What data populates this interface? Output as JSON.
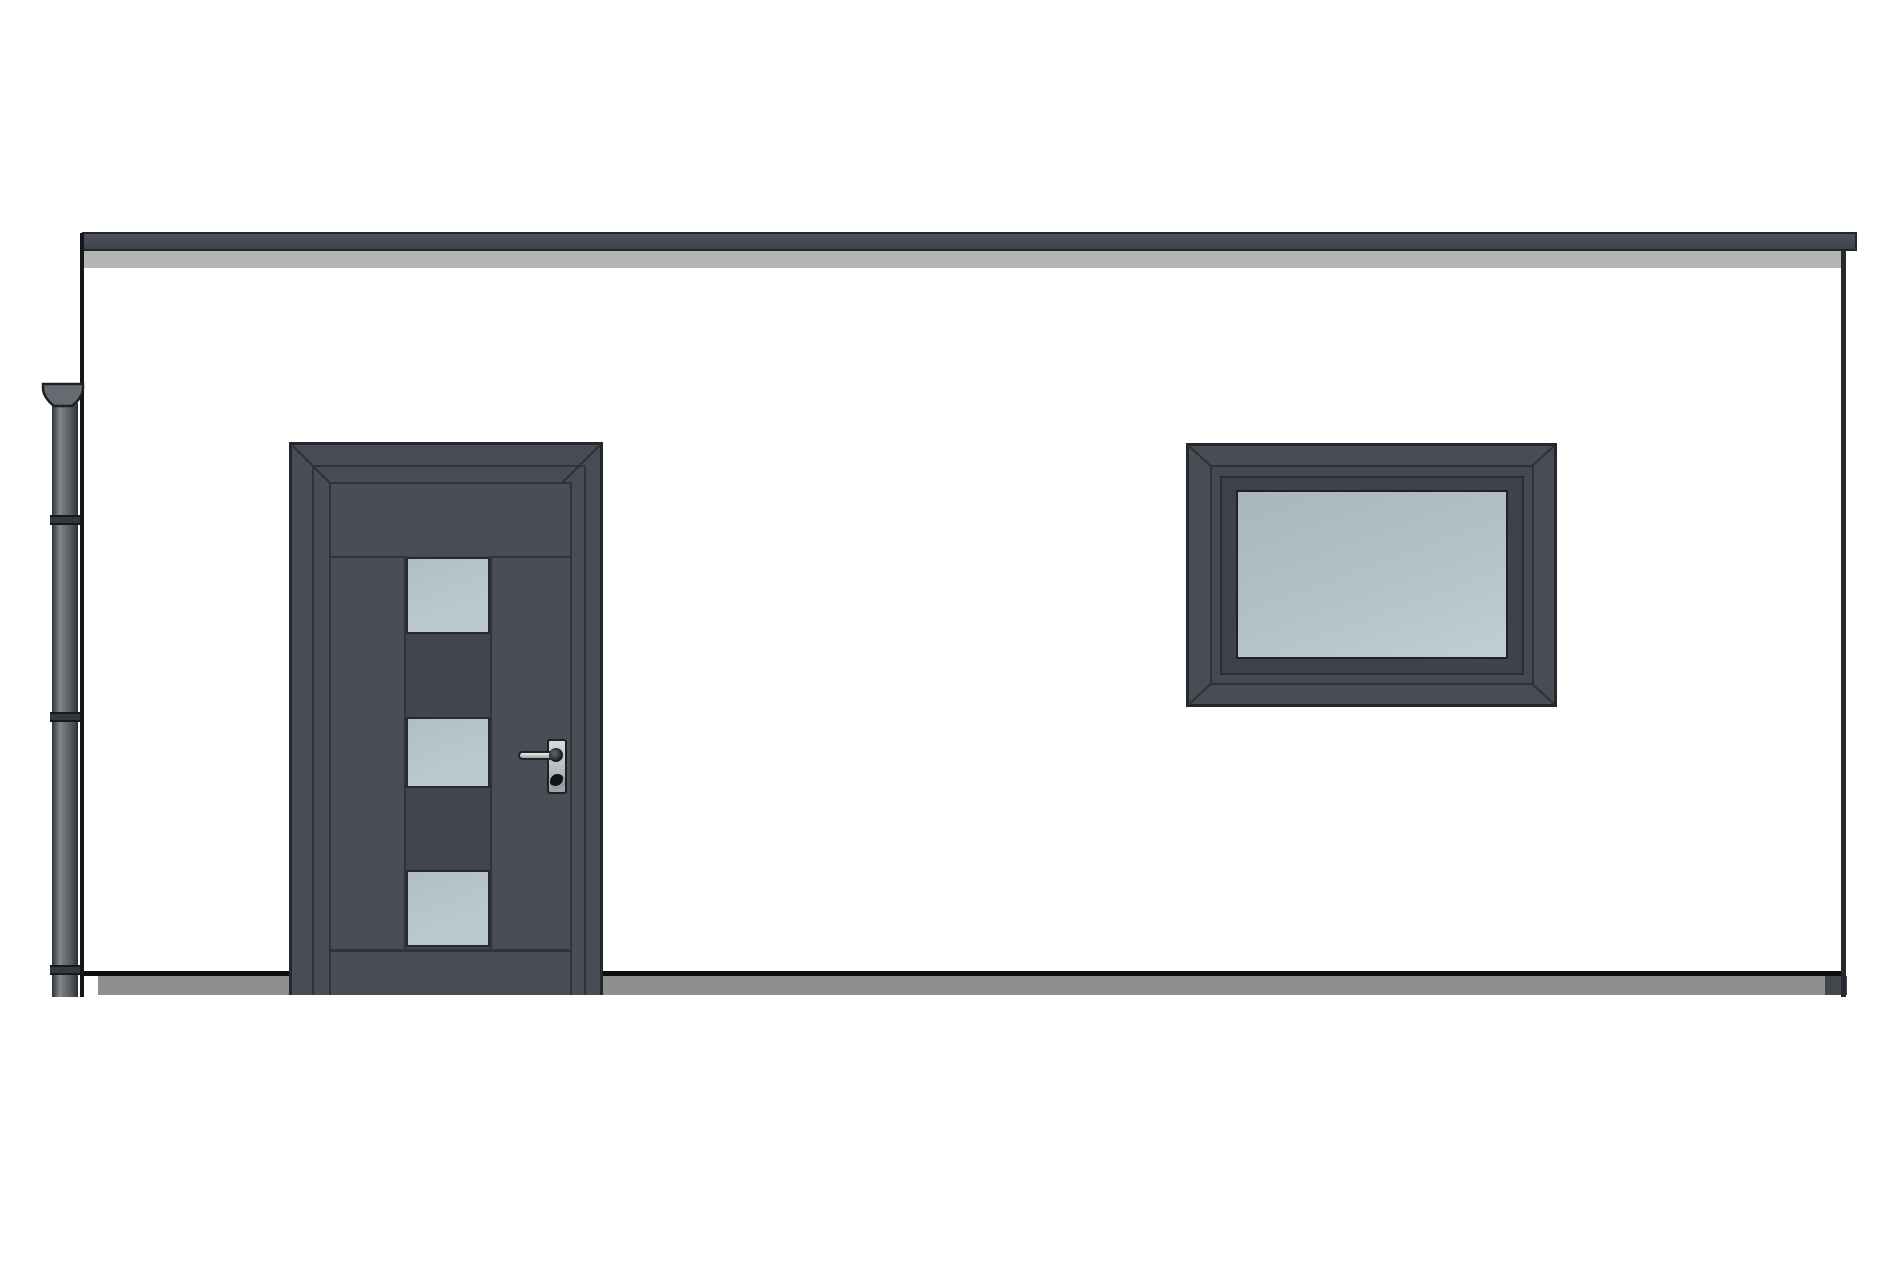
{
  "scene": {
    "type": "architectural elevation drawing",
    "title": "Front elevation - flat-roof building with entrance door, fixed window, downpipe and ground line",
    "components": {
      "roof_fascia": "flat roof fascia band with shadow strip",
      "wall": "white rendered wall",
      "downpipe": "rainwater downpipe with top hopper and pipe collars",
      "door": "anthracite entrance door, three obscured glass panels, lever handle with cylinder keyhole",
      "window": "anthracite fixed window with double-stepped frame and obscured glazing",
      "ground": "ground slab line and paving strip"
    },
    "counts": {
      "door_glass_panels": 3,
      "downpipe_collars": 3
    }
  },
  "colors": {
    "paper": "#ffffff",
    "outline": "#141619",
    "frame_dark": "#474c55",
    "frame_edge": "#24282d",
    "frame_groove": "#2f343a",
    "door_leaf": "#494e56",
    "glass_gap": "#41454c",
    "door_glass": "#bcc8d0",
    "window_glass": "#b5c1c9",
    "fascia": "#454a52",
    "fascia_shadow": "#b5b5b5",
    "ground": "#8f8f8f",
    "ground_end": "#43474d",
    "pipe_mid": "#6d7178",
    "pipe_dark": "#2e3237",
    "pipe_light": "#83878d",
    "hopper": "#666a71",
    "metal_light": "#d9dadc",
    "metal_dark": "#9fa1a5"
  }
}
